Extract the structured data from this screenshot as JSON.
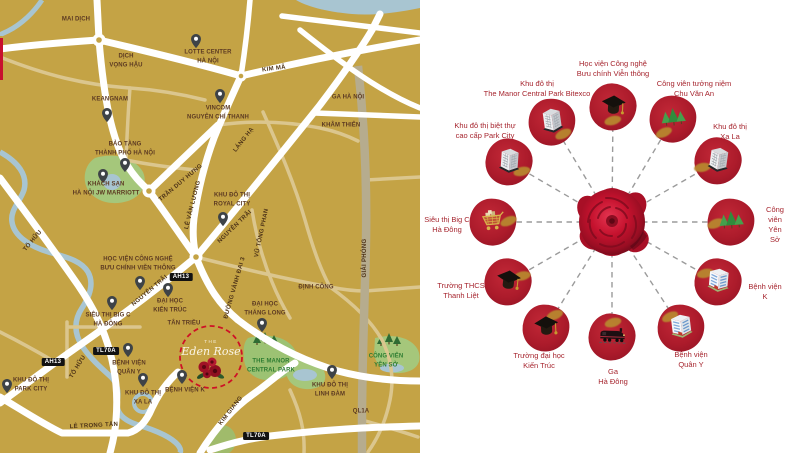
{
  "map": {
    "background_color": "#C4A345",
    "texts": [
      {
        "text": "MAI DỊCH"
      },
      {
        "text": "DỊCH\nVỌNG HẬU"
      },
      {
        "text": "KEANGNAM"
      },
      {
        "text": "LOTTE CENTER\nHÀ NỘI"
      },
      {
        "text": "VINCOM\nNGUYỄN CHÍ THANH"
      },
      {
        "text": "GA HÀ NỘI"
      },
      {
        "text": "KHÂM THIÊN"
      },
      {
        "text": "BẢO TÀNG\nTHÀNH PHỐ HÀ NỘI"
      },
      {
        "text": "KHÁCH SẠN\nHÀ NỘI JW MARRIOTT"
      },
      {
        "text": "KHU ĐÔ THỊ\nROYAL CITY"
      },
      {
        "text": "HỌC VIỆN CÔNG NGHỆ\nBƯU CHÍNH VIỄN THÔNG"
      },
      {
        "text": "ĐẠI HỌC\nKIẾN TRÚC"
      },
      {
        "text": "TÂN TRIỀU"
      },
      {
        "text": "SIÊU THỊ BIG C\nHÀ ĐÔNG"
      },
      {
        "text": "BỆNH VIỆN\nQUÂN Y"
      },
      {
        "text": "KHU ĐÔ THỊ\nXA LA"
      },
      {
        "text": "BỆNH VIỆN K"
      },
      {
        "text": "KHU ĐÔ THỊ\nPARK CITY"
      },
      {
        "text": "ĐẠI HỌC\nTHĂNG LONG"
      },
      {
        "text": "KHU ĐÔ THỊ\nLINH ĐÀM"
      },
      {
        "text": "ĐỊNH CÔNG"
      },
      {
        "text": "QL1A"
      },
      {
        "text": "THE MANOR\nCENTRAL PARK"
      },
      {
        "text": "CÔNG VIÊN\nYÊN SỞ"
      }
    ],
    "road_labels": [
      {
        "text": "KIM MÃ"
      },
      {
        "text": "LÁNG HẠ"
      },
      {
        "text": "TRẦN DUY HƯNG"
      },
      {
        "text": "LÊ VĂN LƯƠNG"
      },
      {
        "text": "TỐ HỮU"
      },
      {
        "text": "TỐ HỮU"
      },
      {
        "text": "NGUYỄN TRÃI"
      },
      {
        "text": "NGUYỄN TRÃI"
      },
      {
        "text": "VŨ TÔNG PHAN"
      },
      {
        "text": "GIẢI PHÓNG"
      },
      {
        "text": "ĐƯỜNG VÀNH ĐAI 3"
      },
      {
        "text": "KIM GIANG"
      },
      {
        "text": "LÊ TRỌNG TẤN"
      }
    ],
    "badges": [
      {
        "text": "AH13"
      },
      {
        "text": "AH13"
      },
      {
        "text": "TL70A"
      },
      {
        "text": "TL70A"
      }
    ],
    "project": {
      "the": "THE",
      "name": "Eden Rose"
    }
  },
  "diagram": {
    "center_icon": "rose-icon",
    "colors": {
      "node_red": "#AC1B2B",
      "label_red": "#A6252E",
      "line_gray": "#9B9B9B",
      "gold": "#B8892F"
    },
    "nodes": [
      {
        "label": "Học viện Công nghệ\nBưu chính Viễn thông",
        "icon": "graduation-cap-icon"
      },
      {
        "label": "Công viên tưởng niệm\nChu Văn An",
        "icon": "park-trees-icon"
      },
      {
        "label": "Khu đô thị\nXa La",
        "icon": "building-icon"
      },
      {
        "label": "Công viên\nYên Sở",
        "icon": "park-trees-icon"
      },
      {
        "label": "Bệnh viện\nK",
        "icon": "hospital-icon"
      },
      {
        "label": "Bệnh viện\nQuân Y",
        "icon": "hospital-icon"
      },
      {
        "label": "Ga\nHà Đông",
        "icon": "train-icon"
      },
      {
        "label": "Trường đại học\nKiến Trúc",
        "icon": "graduation-cap-icon"
      },
      {
        "label": "Trường THCS\nThanh Liệt",
        "icon": "graduation-cap-icon"
      },
      {
        "label": "Siêu thị Big C\nHà Đông",
        "icon": "cart-icon"
      },
      {
        "label": "Khu đô thị biệt thự\ncao cấp Park City",
        "icon": "building-icon"
      },
      {
        "label": "Khu đô thị\nThe Manor Central Park Bitexco",
        "icon": "building-icon"
      }
    ]
  }
}
